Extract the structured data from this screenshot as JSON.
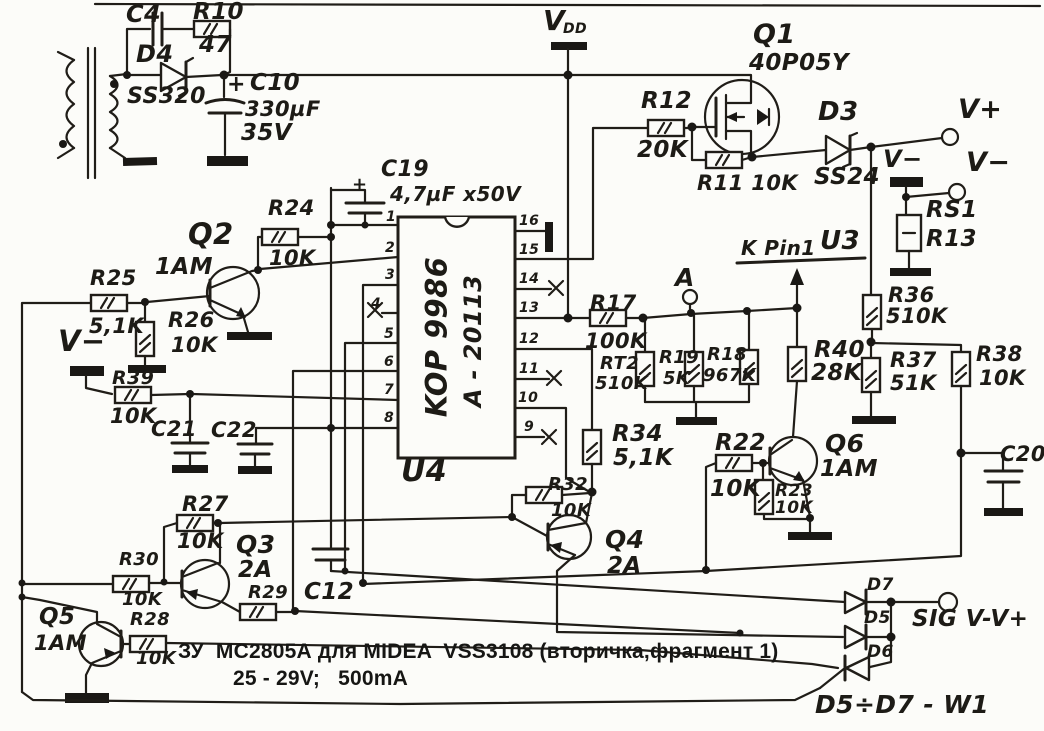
{
  "caption": {
    "line1": "ЗУ  МС2805А для MIDEA  VSS3108 (вторичка,фрагмент 1)",
    "line2": "25 - 29V;   500mA"
  },
  "ic": {
    "ref": "U4",
    "part": "KOP 9986",
    "code": "A - 20113"
  },
  "colors": {
    "ink": "#201d18",
    "paper": "#fcfcf9"
  },
  "labels": [
    {
      "name": "label-c4",
      "t": "C4",
      "x": 126,
      "y": 2,
      "s": 24
    },
    {
      "name": "label-r10",
      "t": "R10",
      "x": 193,
      "y": 1,
      "s": 23
    },
    {
      "name": "label-r10-value",
      "t": "47",
      "x": 199,
      "y": 34,
      "s": 23
    },
    {
      "name": "label-d4",
      "t": "D4",
      "x": 136,
      "y": 42,
      "s": 24
    },
    {
      "name": "label-d4-part",
      "t": "SS320",
      "x": 127,
      "y": 86,
      "s": 22
    },
    {
      "name": "label-c10-plus",
      "t": "+",
      "x": 227,
      "y": 74,
      "s": 22,
      "b": 1
    },
    {
      "name": "label-c10",
      "t": "C10",
      "x": 250,
      "y": 72,
      "s": 23
    },
    {
      "name": "label-c10-value",
      "t": "330µF",
      "x": 245,
      "y": 99,
      "s": 21
    },
    {
      "name": "label-c10-voltage",
      "t": "35V",
      "x": 241,
      "y": 122,
      "s": 23
    },
    {
      "name": "label-vdd-v",
      "t": "V",
      "x": 543,
      "y": 7,
      "s": 28,
      "b": 1
    },
    {
      "name": "label-vdd-sub",
      "t": "DD",
      "x": 563,
      "y": 22,
      "s": 14,
      "b": 1
    },
    {
      "name": "label-q1",
      "t": "Q1",
      "x": 753,
      "y": 21,
      "s": 27,
      "b": 1
    },
    {
      "name": "label-q1-part",
      "t": "40P05Y",
      "x": 749,
      "y": 52,
      "s": 23
    },
    {
      "name": "label-r12",
      "t": "R12",
      "x": 641,
      "y": 90,
      "s": 23
    },
    {
      "name": "label-r12-value",
      "t": "20K",
      "x": 637,
      "y": 139,
      "s": 23
    },
    {
      "name": "label-r11",
      "t": "R11 10K",
      "x": 697,
      "y": 173,
      "s": 21
    },
    {
      "name": "label-d3",
      "t": "D3",
      "x": 818,
      "y": 99,
      "s": 26,
      "b": 1
    },
    {
      "name": "label-d3-part",
      "t": "SS24",
      "x": 814,
      "y": 166,
      "s": 23
    },
    {
      "name": "label-vplus",
      "t": "V+",
      "x": 958,
      "y": 96,
      "s": 27,
      "b": 1
    },
    {
      "name": "label-vminus-flag",
      "t": "V−",
      "x": 883,
      "y": 147,
      "s": 24,
      "b": 1
    },
    {
      "name": "label-vminus-terminal",
      "t": "V−",
      "x": 966,
      "y": 149,
      "s": 27,
      "b": 1
    },
    {
      "name": "label-rs1",
      "t": "RS1",
      "x": 926,
      "y": 199,
      "s": 23
    },
    {
      "name": "label-r13",
      "t": "R13",
      "x": 926,
      "y": 228,
      "s": 23
    },
    {
      "name": "label-c19",
      "t": "C19",
      "x": 381,
      "y": 159,
      "s": 22
    },
    {
      "name": "label-c19-value",
      "t": "4,7µF x50V",
      "x": 390,
      "y": 184,
      "s": 20
    },
    {
      "name": "label-c19-plus",
      "t": "+",
      "x": 352,
      "y": 176,
      "s": 18,
      "b": 1
    },
    {
      "name": "label-u4",
      "t": "U4",
      "x": 401,
      "y": 457,
      "s": 30,
      "b": 1
    },
    {
      "name": "ic-part",
      "t": "KOP 9986",
      "x": 437,
      "y": 337,
      "s": 29,
      "b": 1,
      "r": -90,
      "c": 1
    },
    {
      "name": "ic-code",
      "t": "A - 20113",
      "x": 473,
      "y": 341,
      "s": 24,
      "r": -90,
      "c": 1
    },
    {
      "name": "pin-1",
      "t": "1",
      "x": 386,
      "y": 210,
      "s": 14
    },
    {
      "name": "pin-2",
      "t": "2",
      "x": 385,
      "y": 241,
      "s": 14
    },
    {
      "name": "pin-3",
      "t": "3",
      "x": 385,
      "y": 268,
      "s": 14
    },
    {
      "name": "pin-4",
      "t": "4",
      "x": 371,
      "y": 297,
      "s": 14
    },
    {
      "name": "pin-5",
      "t": "5",
      "x": 384,
      "y": 327,
      "s": 14
    },
    {
      "name": "pin-6",
      "t": "6",
      "x": 384,
      "y": 355,
      "s": 14
    },
    {
      "name": "pin-7",
      "t": "7",
      "x": 384,
      "y": 383,
      "s": 14
    },
    {
      "name": "pin-8",
      "t": "8",
      "x": 384,
      "y": 411,
      "s": 14
    },
    {
      "name": "pin-16",
      "t": "16",
      "x": 519,
      "y": 214,
      "s": 14
    },
    {
      "name": "pin-15",
      "t": "15",
      "x": 519,
      "y": 243,
      "s": 14
    },
    {
      "name": "pin-14",
      "t": "14",
      "x": 519,
      "y": 272,
      "s": 14
    },
    {
      "name": "pin-13",
      "t": "13",
      "x": 519,
      "y": 301,
      "s": 14
    },
    {
      "name": "pin-12",
      "t": "12",
      "x": 519,
      "y": 332,
      "s": 14
    },
    {
      "name": "pin-11",
      "t": "11",
      "x": 519,
      "y": 362,
      "s": 14
    },
    {
      "name": "pin-10",
      "t": "10",
      "x": 518,
      "y": 391,
      "s": 14
    },
    {
      "name": "pin-9",
      "t": "9",
      "x": 524,
      "y": 420,
      "s": 14
    },
    {
      "name": "label-q2",
      "t": "Q2",
      "x": 188,
      "y": 220,
      "s": 29,
      "b": 1
    },
    {
      "name": "label-q2-part",
      "t": "1AM",
      "x": 155,
      "y": 256,
      "s": 23
    },
    {
      "name": "label-r24",
      "t": "R24",
      "x": 268,
      "y": 198,
      "s": 21
    },
    {
      "name": "label-r24-value",
      "t": "10K",
      "x": 269,
      "y": 248,
      "s": 21
    },
    {
      "name": "label-r25",
      "t": "R25",
      "x": 90,
      "y": 268,
      "s": 21
    },
    {
      "name": "label-r25-value",
      "t": "5,1K",
      "x": 89,
      "y": 316,
      "s": 21
    },
    {
      "name": "label-r26",
      "t": "R26",
      "x": 168,
      "y": 310,
      "s": 21
    },
    {
      "name": "label-r26-value",
      "t": "10K",
      "x": 171,
      "y": 335,
      "s": 21
    },
    {
      "name": "label-vminus-left",
      "t": "V−",
      "x": 58,
      "y": 327,
      "s": 29,
      "b": 1
    },
    {
      "name": "label-r39",
      "t": "R39",
      "x": 112,
      "y": 369,
      "s": 19
    },
    {
      "name": "label-r39-value",
      "t": "10K",
      "x": 110,
      "y": 406,
      "s": 21
    },
    {
      "name": "label-c21",
      "t": "C21",
      "x": 151,
      "y": 419,
      "s": 21
    },
    {
      "name": "label-c22",
      "t": "C22",
      "x": 211,
      "y": 420,
      "s": 21
    },
    {
      "name": "label-r17",
      "t": "R17",
      "x": 590,
      "y": 293,
      "s": 21
    },
    {
      "name": "label-r17-value",
      "t": "100K",
      "x": 585,
      "y": 331,
      "s": 21
    },
    {
      "name": "label-a-terminal",
      "t": "A",
      "x": 675,
      "y": 265,
      "s": 25,
      "b": 1
    },
    {
      "name": "label-kpin1",
      "t": "K Pin1",
      "x": 741,
      "y": 238,
      "s": 20,
      "b": 1
    },
    {
      "name": "label-u3",
      "t": "U3",
      "x": 820,
      "y": 228,
      "s": 26,
      "b": 1
    },
    {
      "name": "label-rt2",
      "t": "RT2",
      "x": 600,
      "y": 355,
      "s": 18
    },
    {
      "name": "label-rt2-value",
      "t": "510K",
      "x": 595,
      "y": 375,
      "s": 18
    },
    {
      "name": "label-r19",
      "t": "R19",
      "x": 659,
      "y": 349,
      "s": 18
    },
    {
      "name": "label-r19-value",
      "t": "5K",
      "x": 663,
      "y": 370,
      "s": 18
    },
    {
      "name": "label-r18",
      "t": "R18",
      "x": 707,
      "y": 346,
      "s": 18
    },
    {
      "name": "label-r18-value",
      "t": "967K",
      "x": 703,
      "y": 367,
      "s": 18
    },
    {
      "name": "label-r40",
      "t": "R40",
      "x": 814,
      "y": 339,
      "s": 23
    },
    {
      "name": "label-r40-value",
      "t": "28K",
      "x": 811,
      "y": 362,
      "s": 23
    },
    {
      "name": "label-r36",
      "t": "R36",
      "x": 888,
      "y": 285,
      "s": 21
    },
    {
      "name": "label-r36-value",
      "t": "510K",
      "x": 886,
      "y": 306,
      "s": 21
    },
    {
      "name": "label-r37",
      "t": "R37",
      "x": 890,
      "y": 350,
      "s": 21
    },
    {
      "name": "label-r37-value",
      "t": "51K",
      "x": 890,
      "y": 373,
      "s": 21
    },
    {
      "name": "label-r38",
      "t": "R38",
      "x": 976,
      "y": 344,
      "s": 21
    },
    {
      "name": "label-r38-value",
      "t": "10K",
      "x": 979,
      "y": 368,
      "s": 21
    },
    {
      "name": "label-c20",
      "t": "C20",
      "x": 1000,
      "y": 444,
      "s": 21
    },
    {
      "name": "label-r34",
      "t": "R34",
      "x": 612,
      "y": 423,
      "s": 23
    },
    {
      "name": "label-r34-value",
      "t": "5,1K",
      "x": 613,
      "y": 447,
      "s": 23
    },
    {
      "name": "label-r32",
      "t": "R32",
      "x": 548,
      "y": 476,
      "s": 18
    },
    {
      "name": "label-r32-value",
      "t": "10K",
      "x": 551,
      "y": 502,
      "s": 18
    },
    {
      "name": "label-q4",
      "t": "Q4",
      "x": 605,
      "y": 527,
      "s": 25,
      "b": 1
    },
    {
      "name": "label-q4-part",
      "t": "2A",
      "x": 607,
      "y": 555,
      "s": 23
    },
    {
      "name": "label-r22",
      "t": "R22",
      "x": 715,
      "y": 432,
      "s": 23
    },
    {
      "name": "label-r22-value",
      "t": "10K",
      "x": 710,
      "y": 478,
      "s": 23
    },
    {
      "name": "label-r23",
      "t": "R23",
      "x": 775,
      "y": 483,
      "s": 17
    },
    {
      "name": "label-r23-value",
      "t": "10K",
      "x": 775,
      "y": 500,
      "s": 17
    },
    {
      "name": "label-q6",
      "t": "Q6",
      "x": 825,
      "y": 431,
      "s": 25,
      "b": 1
    },
    {
      "name": "label-q6-part",
      "t": "1AM",
      "x": 820,
      "y": 458,
      "s": 23
    },
    {
      "name": "label-r27",
      "t": "R27",
      "x": 182,
      "y": 494,
      "s": 21
    },
    {
      "name": "label-r27-value",
      "t": "10K",
      "x": 177,
      "y": 531,
      "s": 21
    },
    {
      "name": "label-q3",
      "t": "Q3",
      "x": 236,
      "y": 532,
      "s": 25,
      "b": 1
    },
    {
      "name": "label-q3-part",
      "t": "2A",
      "x": 238,
      "y": 559,
      "s": 23
    },
    {
      "name": "label-r30",
      "t": "R30",
      "x": 119,
      "y": 551,
      "s": 18
    },
    {
      "name": "label-r30-value",
      "t": "10K",
      "x": 122,
      "y": 591,
      "s": 18
    },
    {
      "name": "label-r29",
      "t": "R29",
      "x": 248,
      "y": 584,
      "s": 18
    },
    {
      "name": "label-c12",
      "t": "C12",
      "x": 304,
      "y": 581,
      "s": 23
    },
    {
      "name": "label-q5",
      "t": "Q5",
      "x": 39,
      "y": 606,
      "s": 23,
      "b": 1
    },
    {
      "name": "label-q5-part",
      "t": "1AM",
      "x": 34,
      "y": 633,
      "s": 21
    },
    {
      "name": "label-r28",
      "t": "R28",
      "x": 130,
      "y": 611,
      "s": 18
    },
    {
      "name": "label-r28-value",
      "t": "10K",
      "x": 136,
      "y": 650,
      "s": 18
    },
    {
      "name": "label-d7",
      "t": "D7",
      "x": 867,
      "y": 577,
      "s": 17,
      "b": 1
    },
    {
      "name": "label-d5",
      "t": "D5",
      "x": 864,
      "y": 610,
      "s": 17,
      "b": 1
    },
    {
      "name": "label-d6",
      "t": "D6",
      "x": 867,
      "y": 644,
      "s": 17,
      "b": 1
    },
    {
      "name": "label-sig",
      "t": "SIG V-V+",
      "x": 912,
      "y": 608,
      "s": 23,
      "b": 1
    },
    {
      "name": "label-d5d7-w1",
      "t": "D5÷D7 - W1",
      "x": 815,
      "y": 692,
      "s": 25,
      "b": 1
    }
  ]
}
